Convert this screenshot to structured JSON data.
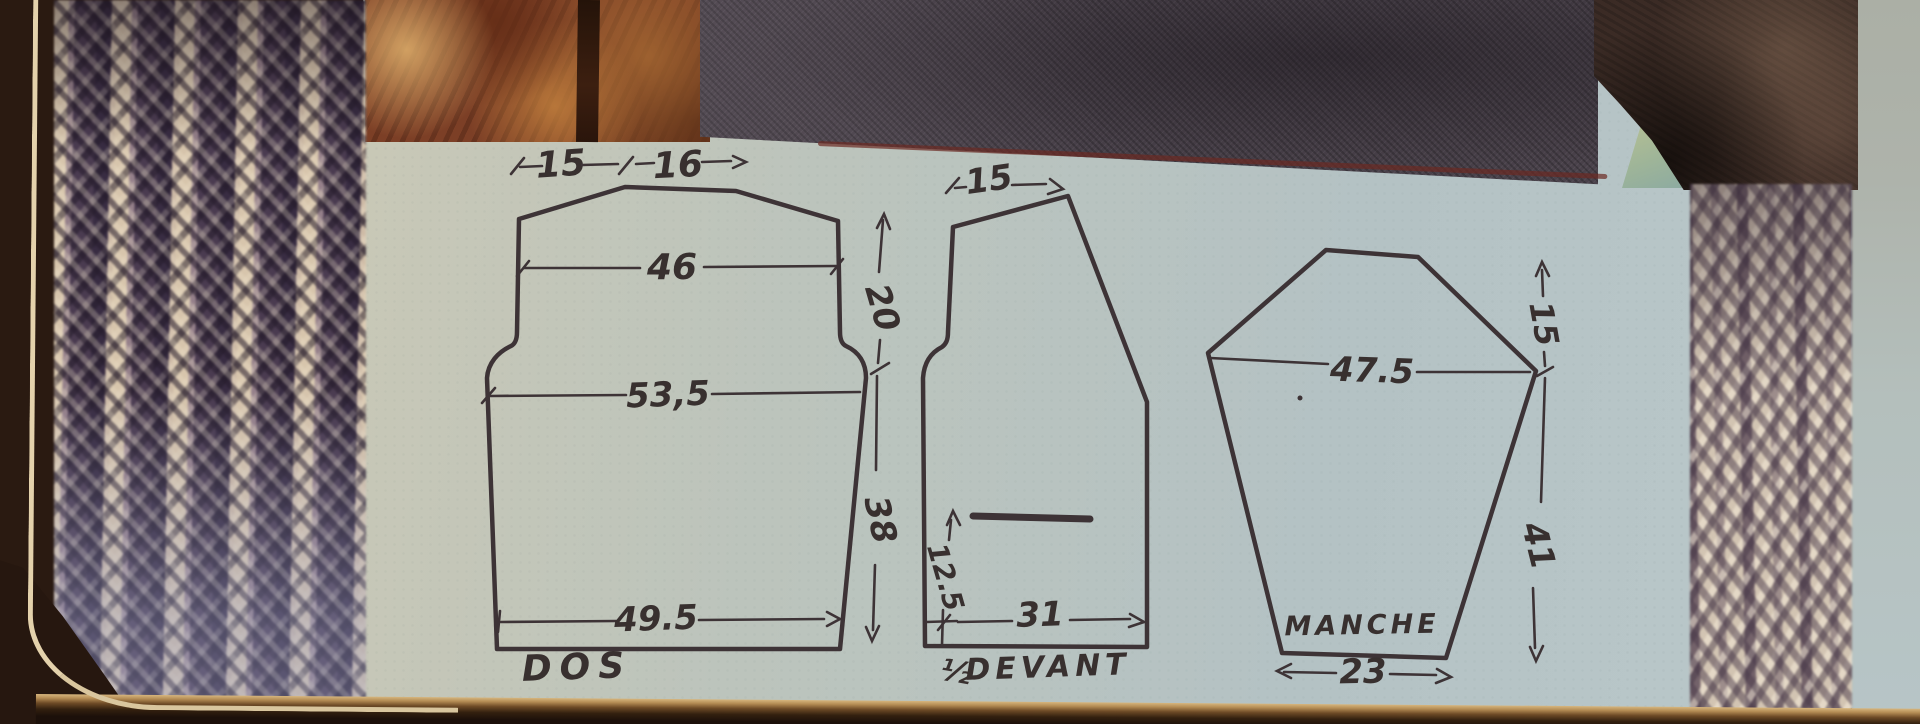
{
  "schematic": {
    "dos": {
      "label": "DOS",
      "dim_shoulder": "15",
      "dim_neck": "16",
      "dim_upper_back": "46",
      "dim_chest": "53,5",
      "dim_hem": "49.5",
      "dim_armhole_depth": "20",
      "dim_length": "38"
    },
    "devant": {
      "label_fraction": "½",
      "label": "DEVANT",
      "dim_shoulder": "15",
      "dim_lower_edge": "12.5",
      "dim_hem": "31"
    },
    "manche": {
      "label": "MANCHE",
      "dim_width": "47.5",
      "dim_cap": "15",
      "dim_underarm": "41",
      "dim_cuff": "23"
    }
  },
  "colors": {
    "paper": "#b8c3c1",
    "ink": "#3d3336",
    "page_background": "#2a1a11",
    "photo_red_line": "#6b2a22",
    "knit_dark": "#49394b",
    "knit_light": "#d9c8b2"
  }
}
